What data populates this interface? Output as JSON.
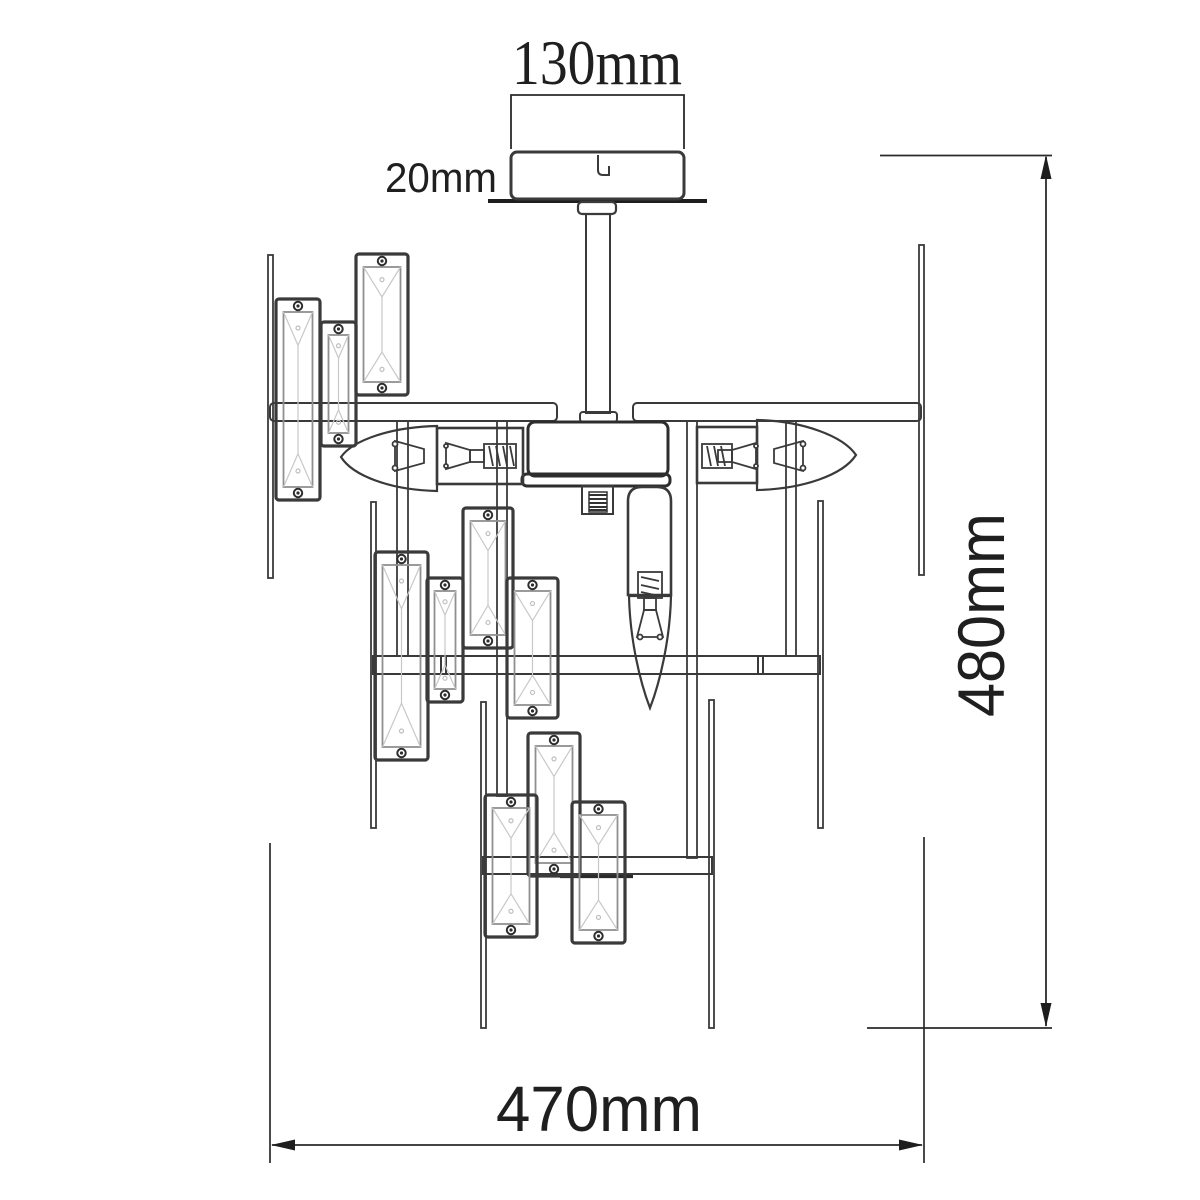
{
  "drawing": {
    "kind": "technical-dimension-diagram"
  },
  "dimensions": {
    "canopy_width": {
      "label": "130mm",
      "value": 130,
      "unit": "mm"
    },
    "canopy_height": {
      "label": "20mm",
      "value": 20,
      "unit": "mm"
    },
    "overall_height": {
      "label": "480mm",
      "value": 480,
      "unit": "mm"
    },
    "overall_width": {
      "label": "470mm",
      "value": 470,
      "unit": "mm"
    }
  },
  "colors": {
    "background": "#ffffff",
    "line_primary": "#3a3a3a",
    "line_dark": "#1e1e1e",
    "inner_frame": "#909090",
    "facet_line": "#c8c8c8",
    "dimension_text": "#1f1f1f"
  }
}
